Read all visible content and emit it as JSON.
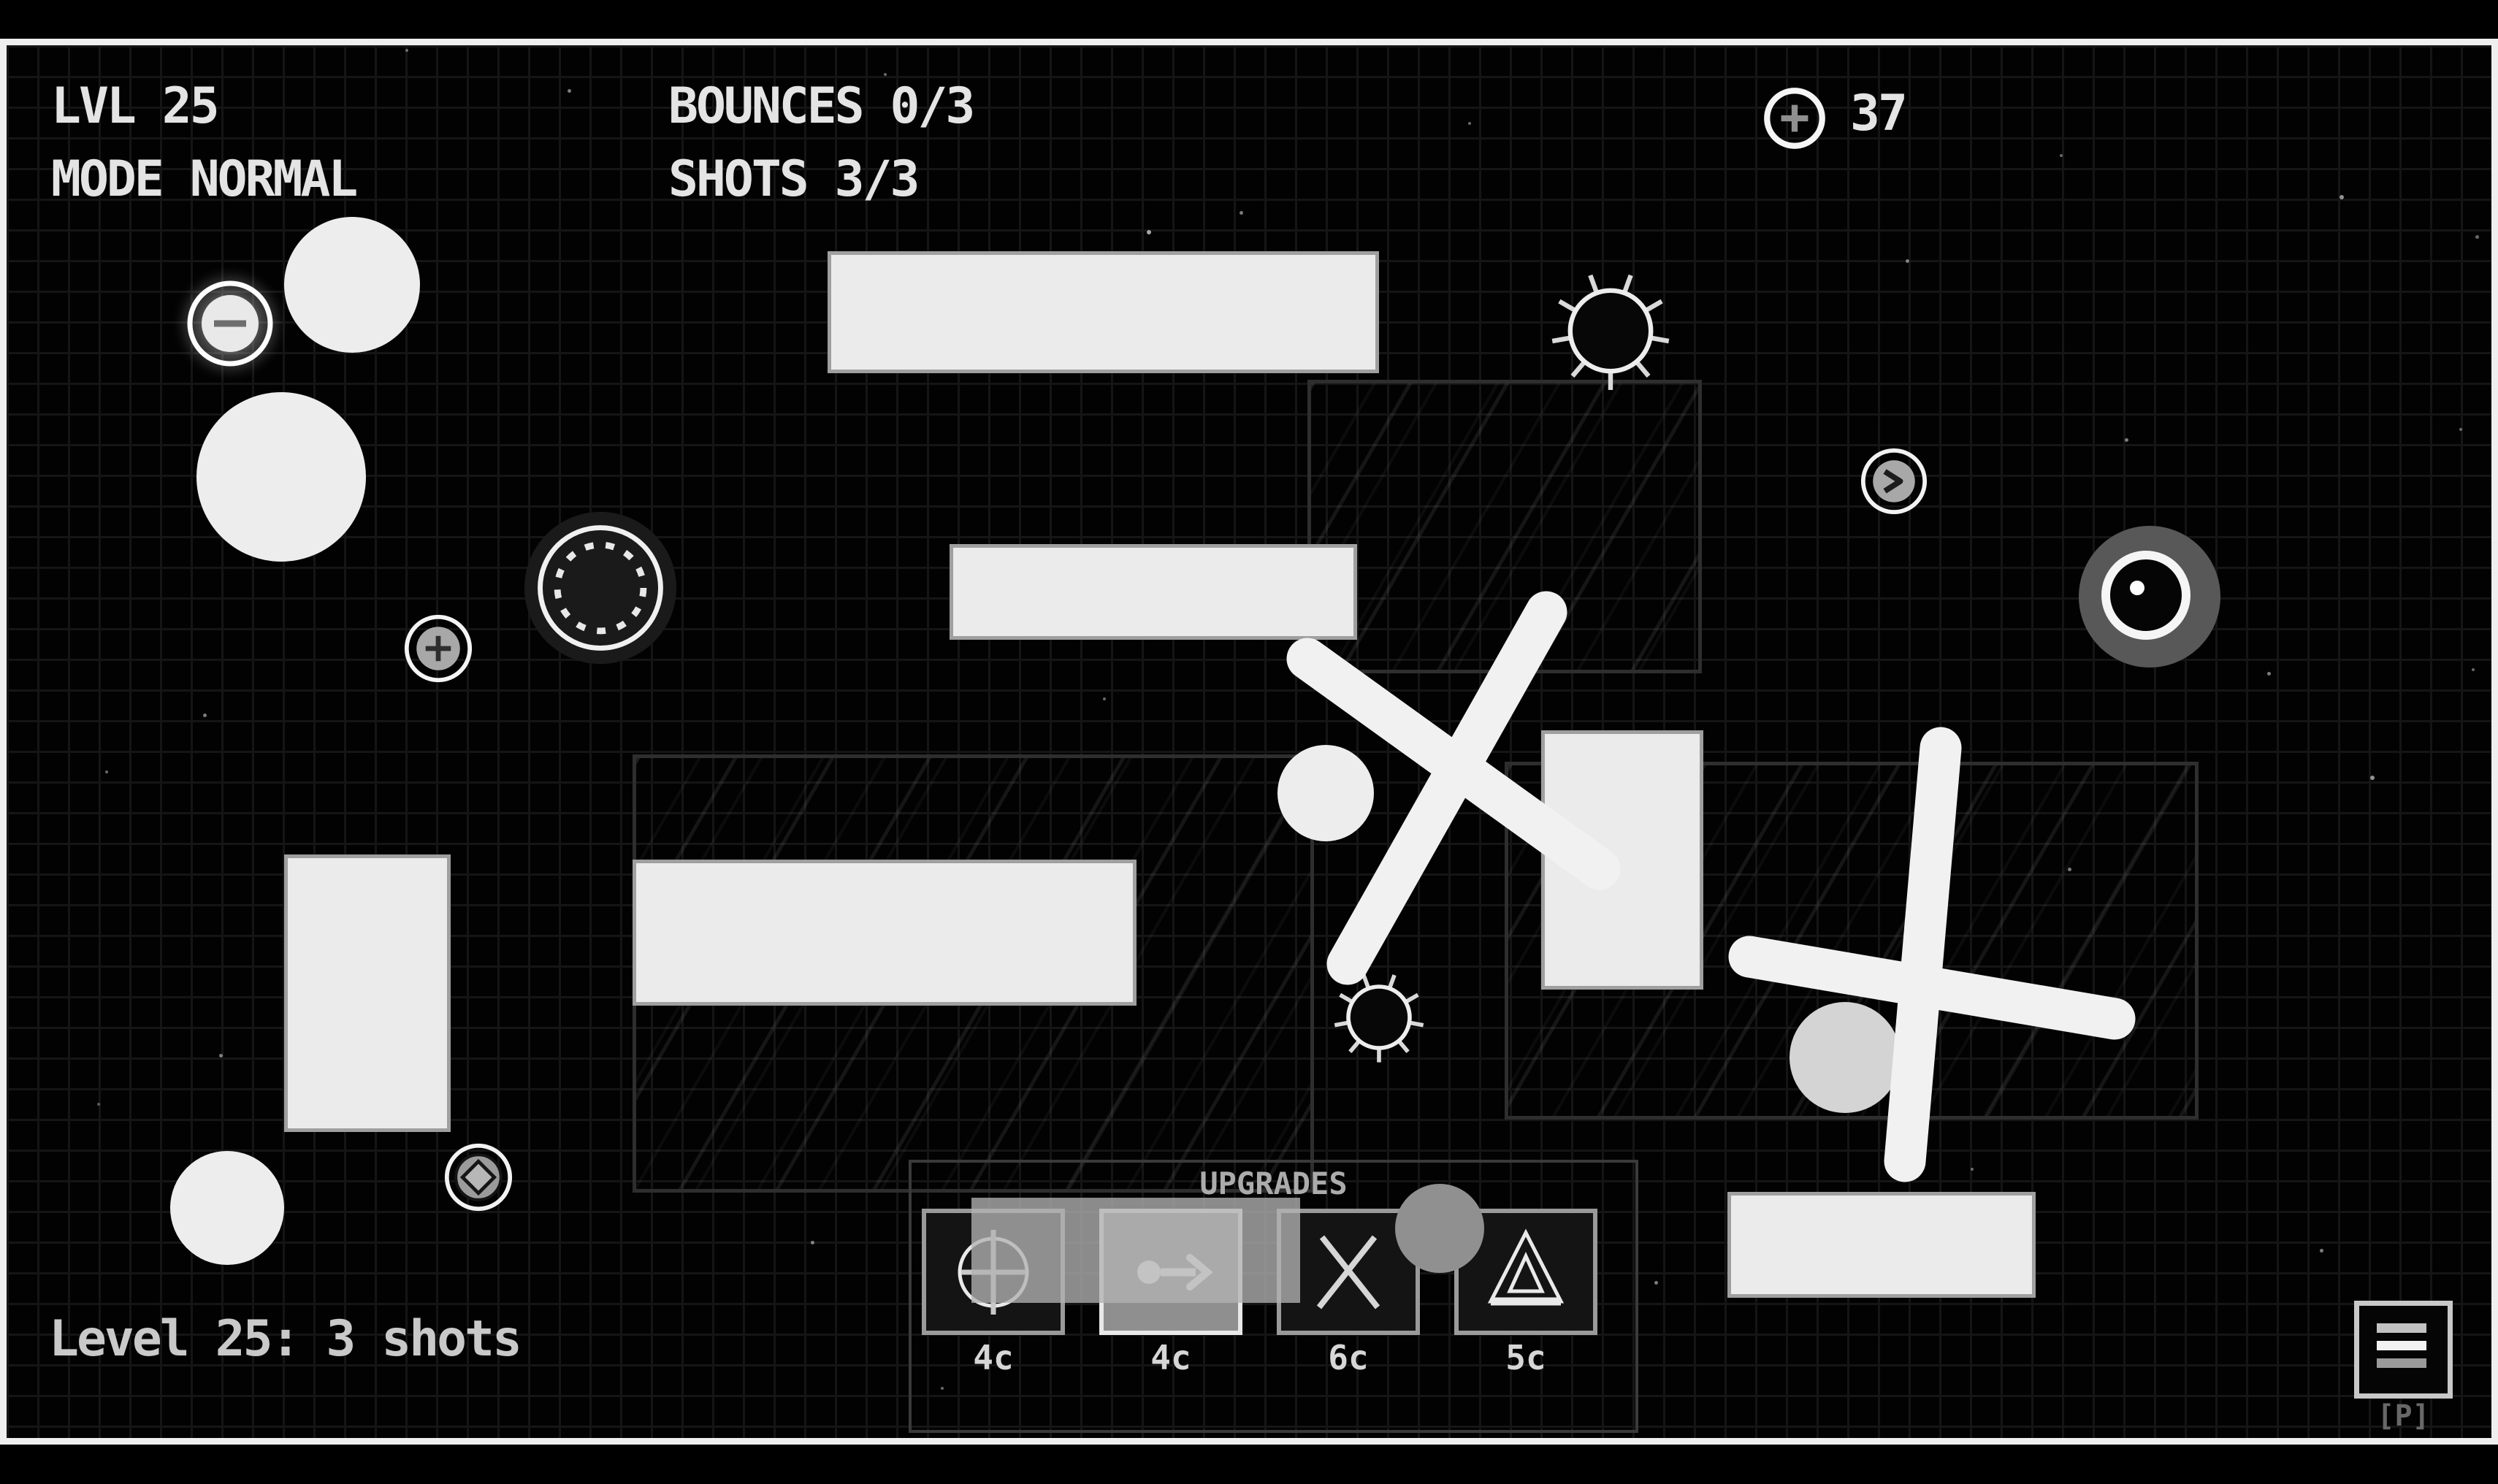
{
  "hud": {
    "level_label": "LVL 25",
    "mode_label": "MODE NORMAL",
    "bounces_label": "BOUNCES 0/3",
    "shots_label": "SHOTS 3/3",
    "coin_count": "37"
  },
  "status_text": "Level 25: 3 shots",
  "upgrades": {
    "title": "UPGRADES",
    "items": [
      {
        "icon": "circle-plus-icon",
        "cost": "4c",
        "selected": false
      },
      {
        "icon": "dot-arrow-icon",
        "cost": "4c",
        "selected": true
      },
      {
        "icon": "cross-icon",
        "cost": "6c",
        "selected": false
      },
      {
        "icon": "triangle-ramp-icon",
        "cost": "5c",
        "selected": false
      }
    ]
  },
  "menu": {
    "pause_hint": "[P]"
  },
  "colors": {
    "frame": "#efefef",
    "platform": "#ebebeb",
    "grid_line": "#151515",
    "background": "#020202",
    "glass_border": "#2e2e2e",
    "highlight": "#b2b2b2"
  }
}
